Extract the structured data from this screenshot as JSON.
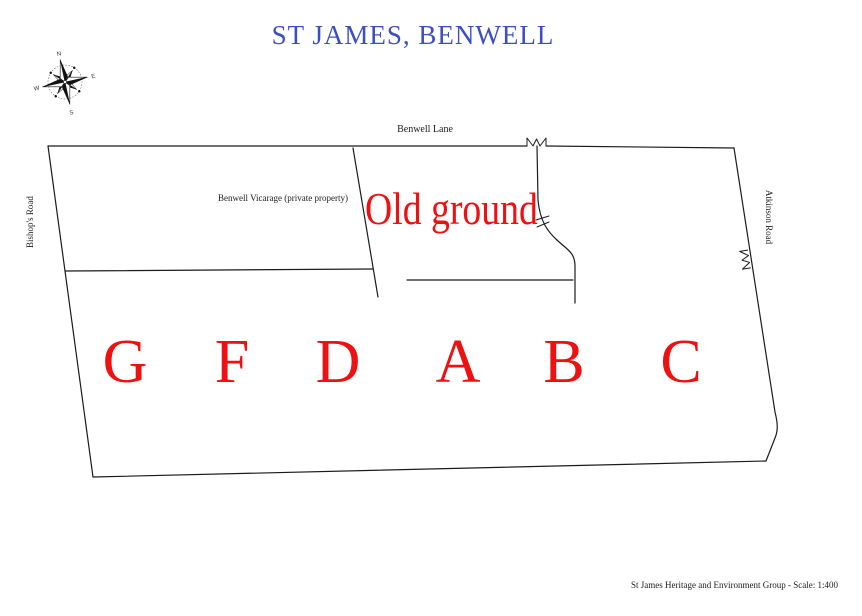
{
  "title": {
    "text": "ST JAMES, BENWELL"
  },
  "colors": {
    "title_blue": "#3b4ec4",
    "accent_red": "#ee1111",
    "line": "#1c1c1c"
  },
  "compass": {
    "north": "N",
    "east": "E",
    "south": "S",
    "west": "W"
  },
  "map": {
    "road_top": "Benwell Lane",
    "road_left": "Bishop's Road",
    "road_right": "Atkinson Road",
    "vicarage_label": "Benwell Vicarage (private property)",
    "old_ground_label": "Old ground",
    "sections": [
      "G",
      "F",
      "D",
      "A",
      "B",
      "C"
    ]
  },
  "footer": {
    "text": "St James Heritage and Environment Group - Scale: 1:400"
  }
}
